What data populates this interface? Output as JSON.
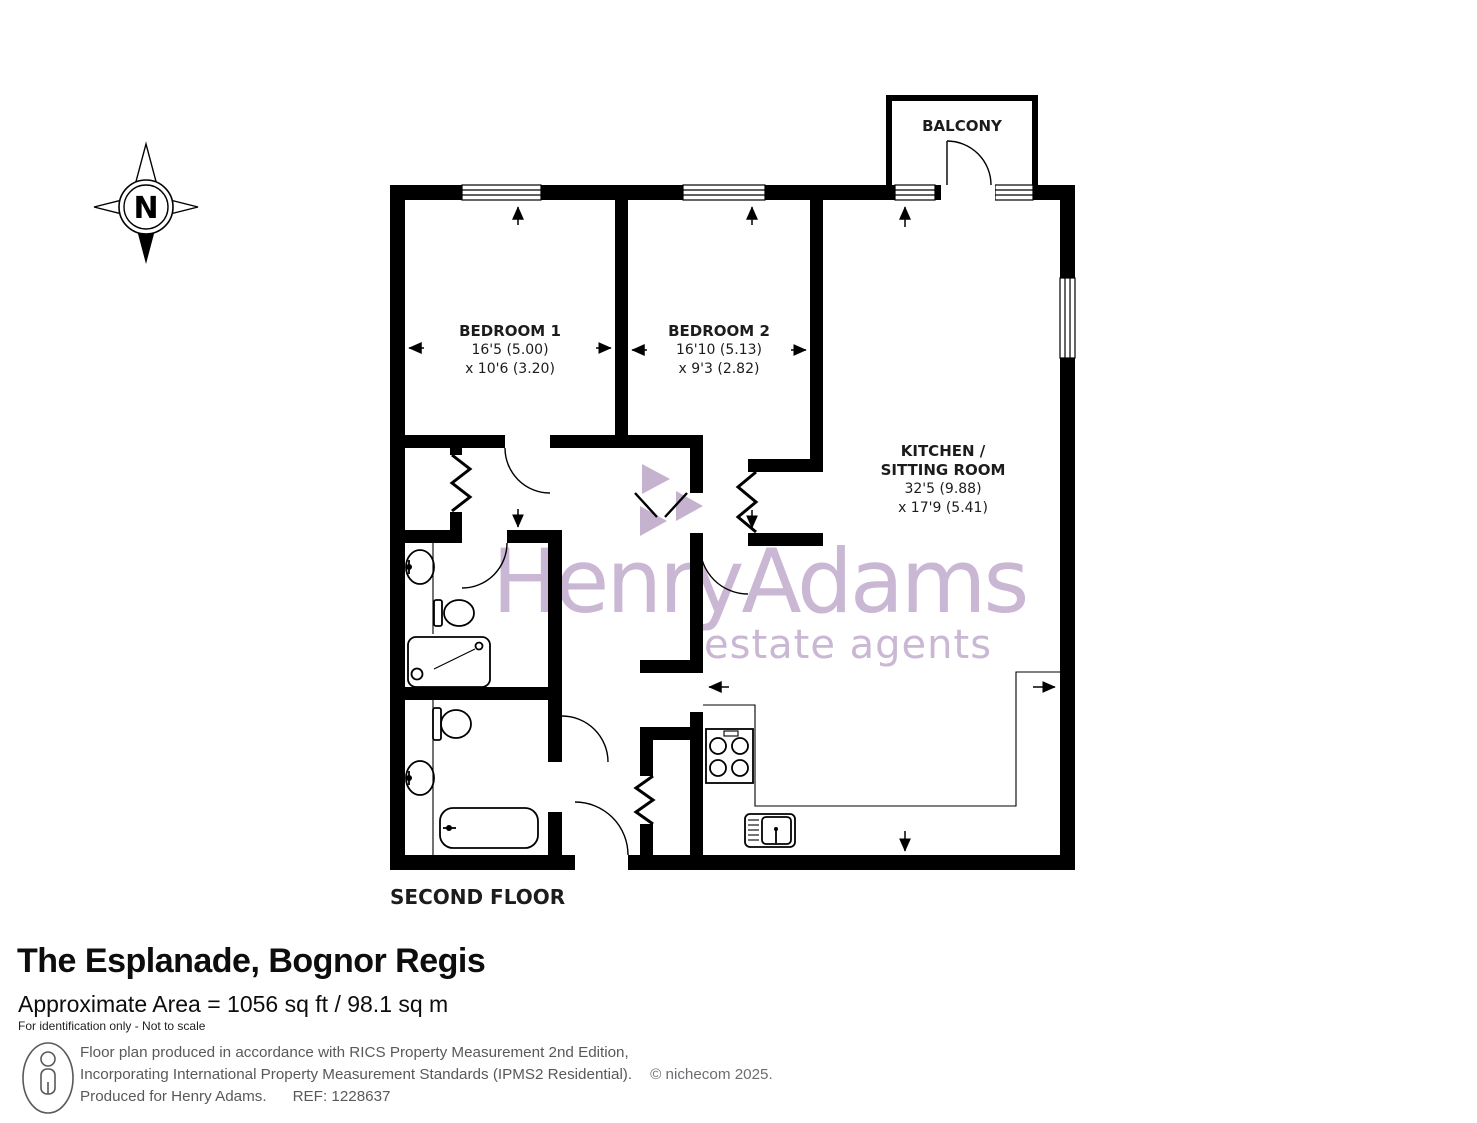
{
  "compass": {
    "label": "N"
  },
  "watermark": {
    "brand": "HenryAdams",
    "tagline": "estate agents",
    "color": "#c9b7d4",
    "logo_color": "#c4b2cf"
  },
  "plan": {
    "floor_label": "SECOND FLOOR",
    "rooms": {
      "balcony": {
        "name": "BALCONY"
      },
      "bedroom1": {
        "name": "BEDROOM 1",
        "dim_line1": "16'5 (5.00)",
        "dim_line2": "x 10'6 (3.20)"
      },
      "bedroom2": {
        "name": "BEDROOM 2",
        "dim_line1": "16'10 (5.13)",
        "dim_line2": "x 9'3 (2.82)"
      },
      "kitchen": {
        "name_line1": "KITCHEN /",
        "name_line2": "SITTING ROOM",
        "dim_line1": "32'5 (9.88)",
        "dim_line2": "x 17'9 (5.41)"
      }
    }
  },
  "details": {
    "title": "The Esplanade, Bognor Regis",
    "area": "Approximate Area = 1056 sq ft / 98.1 sq m",
    "disclaimer": "For identification only - Not to scale"
  },
  "footer": {
    "line1": "Floor plan produced in accordance with RICS Property Measurement 2nd Edition,",
    "line2": "Incorporating International Property Measurement Standards (IPMS2 Residential).",
    "copyright": "© nichecom 2025.",
    "line3": "Produced for Henry Adams.",
    "ref": "REF: 1228637"
  }
}
